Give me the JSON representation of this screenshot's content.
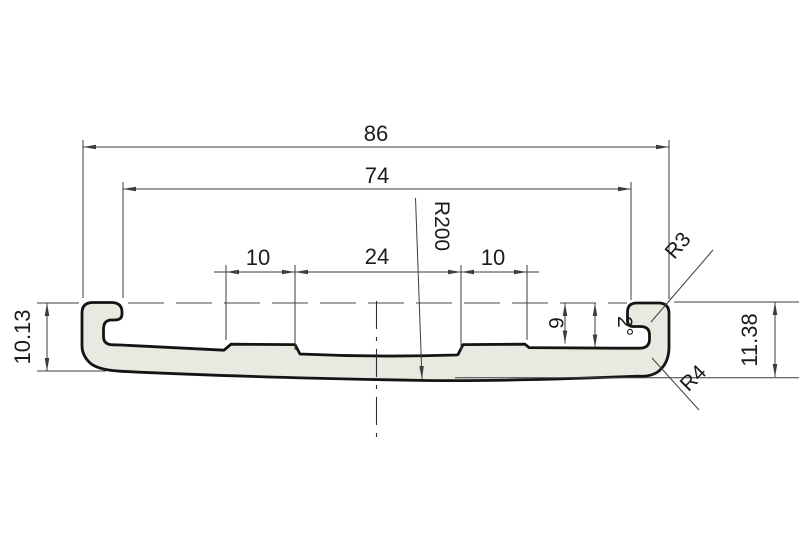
{
  "drawing": {
    "type": "technical-cross-section",
    "background_color": "#ffffff",
    "profile_fill_color": "#eae9e1",
    "profile_outline_color": "#141414",
    "dimension_line_color": "#3d3d3d",
    "dimensions": {
      "overall_width": "86",
      "inner_width": "74",
      "top_left_pad_width": "10",
      "top_center_width": "24",
      "top_right_pad_width": "10",
      "left_end_height": "10.13",
      "right_end_height": "11.38",
      "right_step_depth": "6",
      "draft_angle": "2°",
      "bottom_arc_radius": "R200",
      "hook_inner_radius": "R3",
      "corner_radius": "R4"
    }
  }
}
